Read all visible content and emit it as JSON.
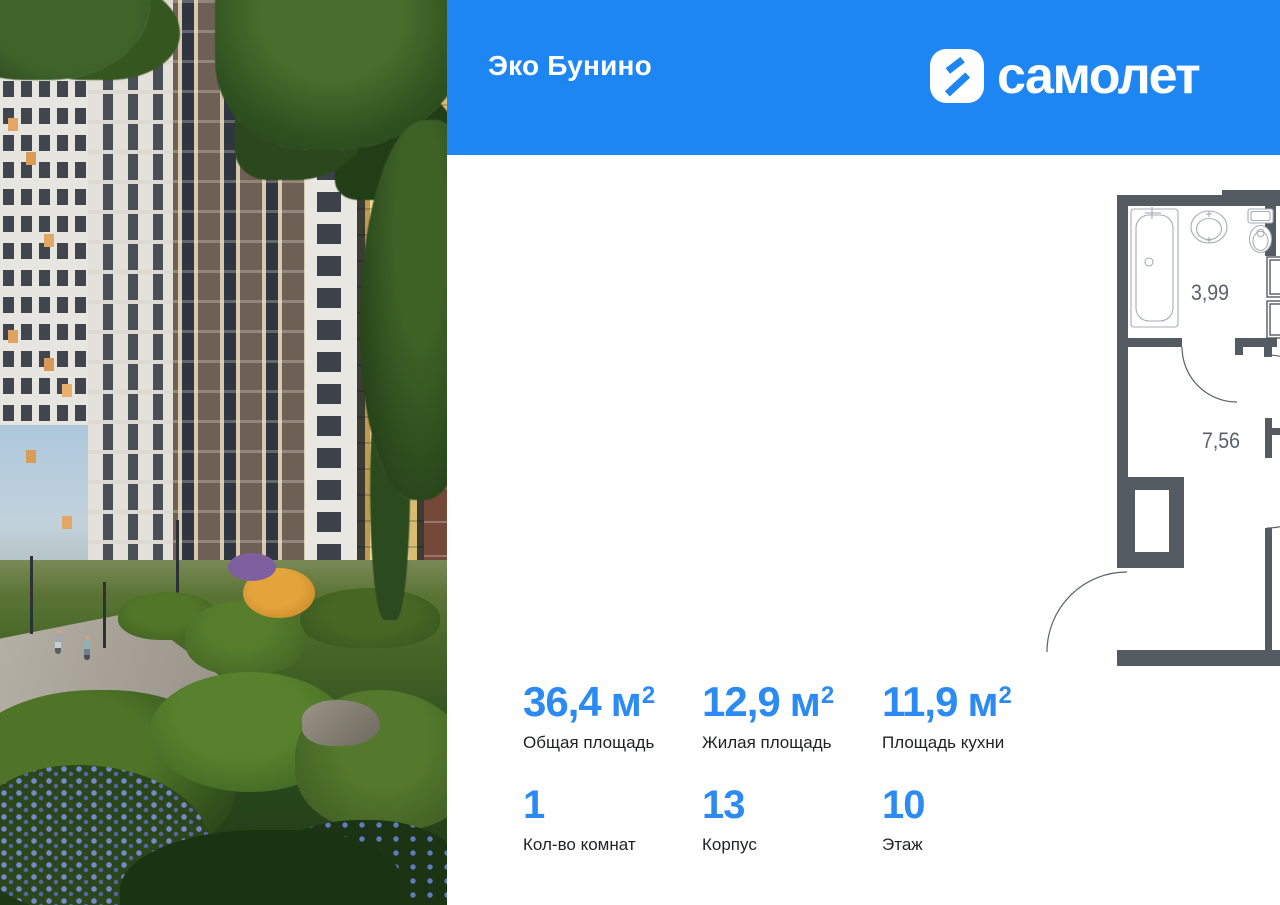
{
  "colors": {
    "header_bg": "#1E86F2",
    "accent_blue": "#2B8BF2",
    "wall_gray": "#555B63",
    "label_dark": "#1F2126",
    "plan_label_gray": "#5A616B"
  },
  "header": {
    "project_title": "Эко Бунино",
    "brand_name": "самолет",
    "brand_icon": "samolet-chevron-icon"
  },
  "floor_plan": {
    "rooms": [
      {
        "name": "bathroom",
        "area": "3,99"
      },
      {
        "name": "kitchen-living",
        "area": "11,90"
      },
      {
        "name": "hallway",
        "area": "7,56"
      },
      {
        "name": "room",
        "area": "12,92"
      }
    ]
  },
  "stats": {
    "areas": [
      {
        "value": "36,4",
        "unit": "м",
        "sup": "2",
        "label": "Общая площадь"
      },
      {
        "value": "12,9",
        "unit": "м",
        "sup": "2",
        "label": "Жилая площадь"
      },
      {
        "value": "11,9",
        "unit": "м",
        "sup": "2",
        "label": "Площадь кухни"
      }
    ],
    "details": [
      {
        "value": "1",
        "label": "Кол-во комнат"
      },
      {
        "value": "13",
        "label": "Корпус"
      },
      {
        "value": "10",
        "label": "Этаж"
      }
    ]
  }
}
